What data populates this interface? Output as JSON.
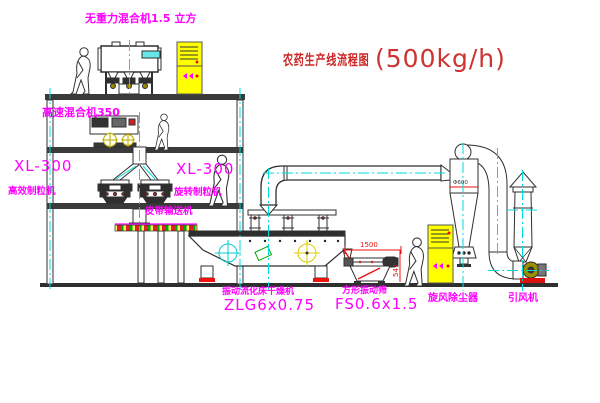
{
  "title": {
    "text": "农药生产线流程图",
    "capacity": "(500kg/h)"
  },
  "labels": {
    "gravity_mixer": "无重力混合机1.5 立方",
    "high_speed_mixer": "高速混合机350",
    "granulator_left_model": "XL-300",
    "granulator_left_name": "高效制粒机",
    "granulator_right_model": "XL-300",
    "granulator_right_name": "旋转制粒机",
    "belt_conveyor": "皮带输送机",
    "dryer_name": "振动流化床干燥机",
    "dryer_model": "ZLG6x0.75",
    "screen_name": "方形振动筛",
    "screen_model": "FS0.6x1.5",
    "cyclone": "旋风除尘器",
    "fan": "引风机"
  },
  "dimensions": {
    "screen_length": "1500",
    "screen_height": "541",
    "cyclone_diameter": "Φ600"
  },
  "colors": {
    "label_magenta": "#ff00ff",
    "title_red": "#cc2626",
    "centerline_cyan": "#00dcdc",
    "cabinet_yellow": "#ffff00",
    "line_dark": "#2f2f2f",
    "accent_red": "#ee1111",
    "accent_green": "#00aa00",
    "fan_olive": "#9a8f00"
  }
}
